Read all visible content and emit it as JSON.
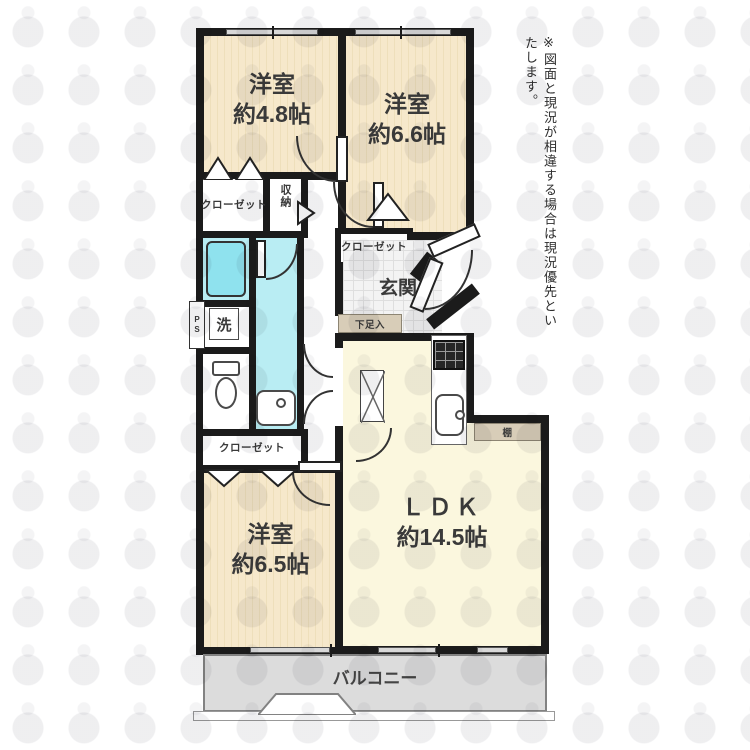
{
  "disclaimer": "※図面と現況が相違する場合は現況優先といたします。",
  "rooms": {
    "bedroom_top_left": {
      "name": "洋室",
      "size": "約4.8帖"
    },
    "bedroom_top_right": {
      "name": "洋室",
      "size": "約6.6帖"
    },
    "bedroom_bottom": {
      "name": "洋室",
      "size": "約6.5帖"
    },
    "ldk": {
      "name": "ＬＤＫ",
      "size": "約14.5帖"
    },
    "entrance": {
      "name": "玄関"
    },
    "balcony": {
      "name": "バルコニー"
    }
  },
  "fixtures": {
    "closet_top_left": "クローゼット",
    "closet_entrance": "クローゼット",
    "closet_bottom": "クローゼット",
    "storage": "収納",
    "laundry": "洗",
    "shoe_cabinet": "下足入",
    "shelf": "棚",
    "pipe_space": "PS"
  },
  "colors": {
    "wall": "#1b1b1b",
    "bedroom_fill": "#f6e8cb",
    "ldk_fill": "#fbf7de",
    "wet_area_fill": "#b9edf3",
    "bathtub_fill": "#8fe2ee",
    "balcony_fill": "#dcdcdc",
    "cabinet_fill": "#d8cdb8",
    "entrance_tile": "#f3f3f3"
  }
}
